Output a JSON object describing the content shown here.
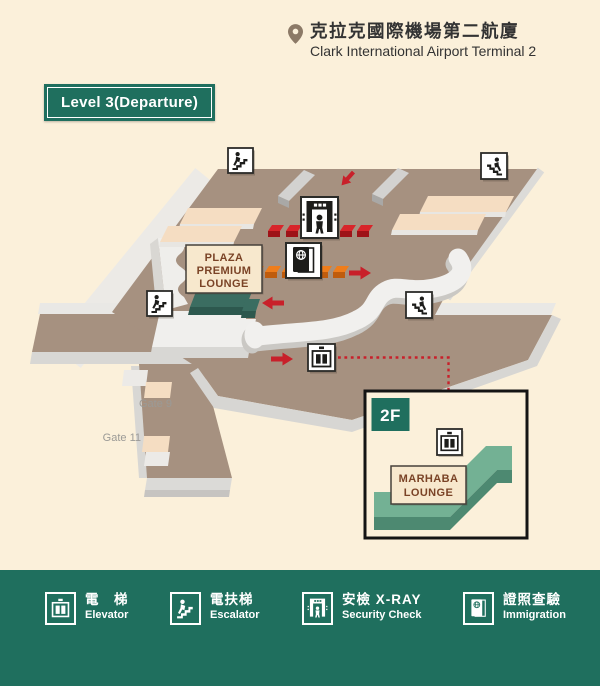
{
  "header": {
    "location_cjk": "克拉克國際機場第二航廈",
    "location_en": "Clark International Airport Terminal 2"
  },
  "level_badge": {
    "label": "Level 3(Departure)"
  },
  "map": {
    "plaza_premium_lounge": {
      "line1": "PLAZA",
      "line2": "PREMIUM",
      "line3": "LOUNGE"
    },
    "gates": {
      "gate9": "Gate 9",
      "gate11": "Gate 11"
    },
    "inset": {
      "floor_label": "2F",
      "marhaba_lounge": {
        "line1": "MARHABA",
        "line2": "LOUNGE"
      }
    }
  },
  "legend": {
    "items": [
      {
        "icon": "elevator-icon",
        "cjk": "電　梯",
        "en": "Elevator"
      },
      {
        "icon": "escalator-icon",
        "cjk": "電扶梯",
        "en": "Escalator"
      },
      {
        "icon": "security-check-icon",
        "cjk": "安檢 X-RAY",
        "en": "Security Check"
      },
      {
        "icon": "immigration-icon",
        "cjk": "證照查驗",
        "en": "Immigration"
      }
    ]
  },
  "colors": {
    "background": "#fbf0da",
    "brand_green": "#1f6f5e",
    "floor_brown": "#a69180",
    "accent_red": "#c8202a",
    "counter_red": "#d8252a",
    "counter_orange": "#ef7d1b",
    "counter_tan": "#f5ddc2",
    "lounge_teal": "#3b6d61",
    "marhaba_green": "#73b194"
  }
}
